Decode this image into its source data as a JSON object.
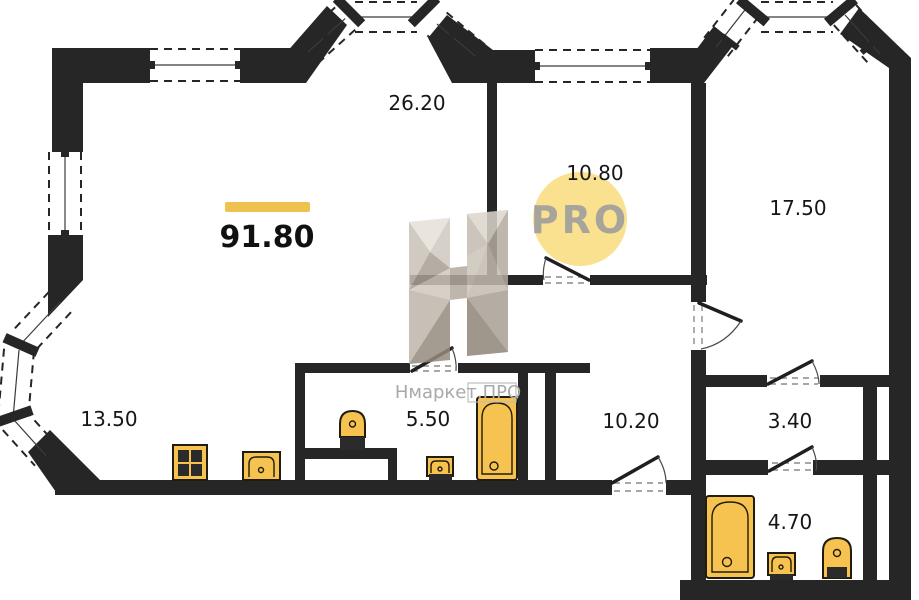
{
  "plan": {
    "total_area": "91.80",
    "rooms": [
      {
        "name": "living-room",
        "area": "26.20"
      },
      {
        "name": "kitchen-niche",
        "area": "10.80"
      },
      {
        "name": "bedroom",
        "area": "17.50"
      },
      {
        "name": "kitchen",
        "area": "13.50"
      },
      {
        "name": "bathroom",
        "area": "5.50"
      },
      {
        "name": "hallway",
        "area": "10.20"
      },
      {
        "name": "corridor",
        "area": "3.40"
      },
      {
        "name": "bathroom-2",
        "area": "4.70"
      }
    ],
    "logo": {
      "text": "PRO"
    },
    "watermark": {
      "brand": "Нмаркет.ПРО"
    },
    "fixtures": [
      "stove",
      "kitchen-sink",
      "toilet",
      "bathtub",
      "wall-sink",
      "bathtub-2",
      "pedestal-sink",
      "toilet-2"
    ],
    "colors": {
      "wall": "#262626",
      "fixture": "#F6C351",
      "accent_bar": "#EFC14F",
      "logo_circle": "#FAE190",
      "logo_text": "#A7A49C",
      "watermark_text": "#A9A9A9"
    }
  }
}
